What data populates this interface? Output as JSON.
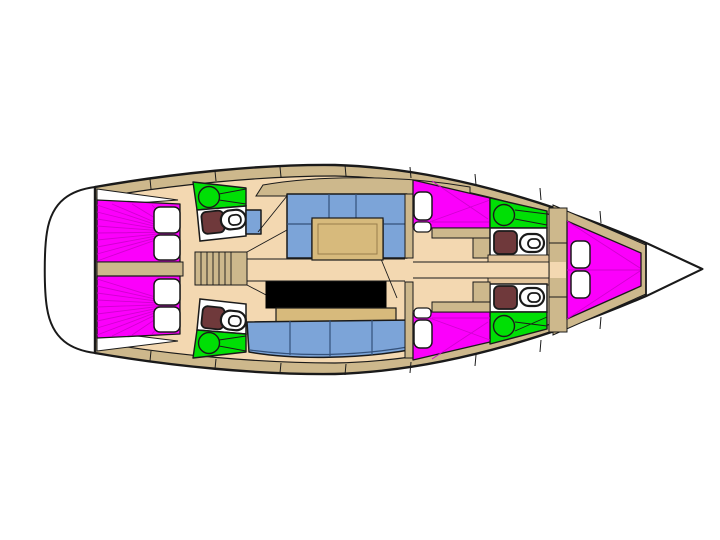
{
  "colors": {
    "background": "#FFFFFF",
    "outline": "#1A1A1A",
    "hull_deck": "#CDB88C",
    "floor": "#F3D8B1",
    "furniture": "#E3C59B",
    "counter": "#D7BA7C",
    "bed": "#FB00FB",
    "bed_seam": "#D100D1",
    "shower": "#00DF05",
    "upholstery": "#7CA4D8",
    "upholstery_seam": "#34517A",
    "toilet_seat": "#6F393B",
    "galley_black": "#000000",
    "fixture_white": "#FFFFFF"
  }
}
